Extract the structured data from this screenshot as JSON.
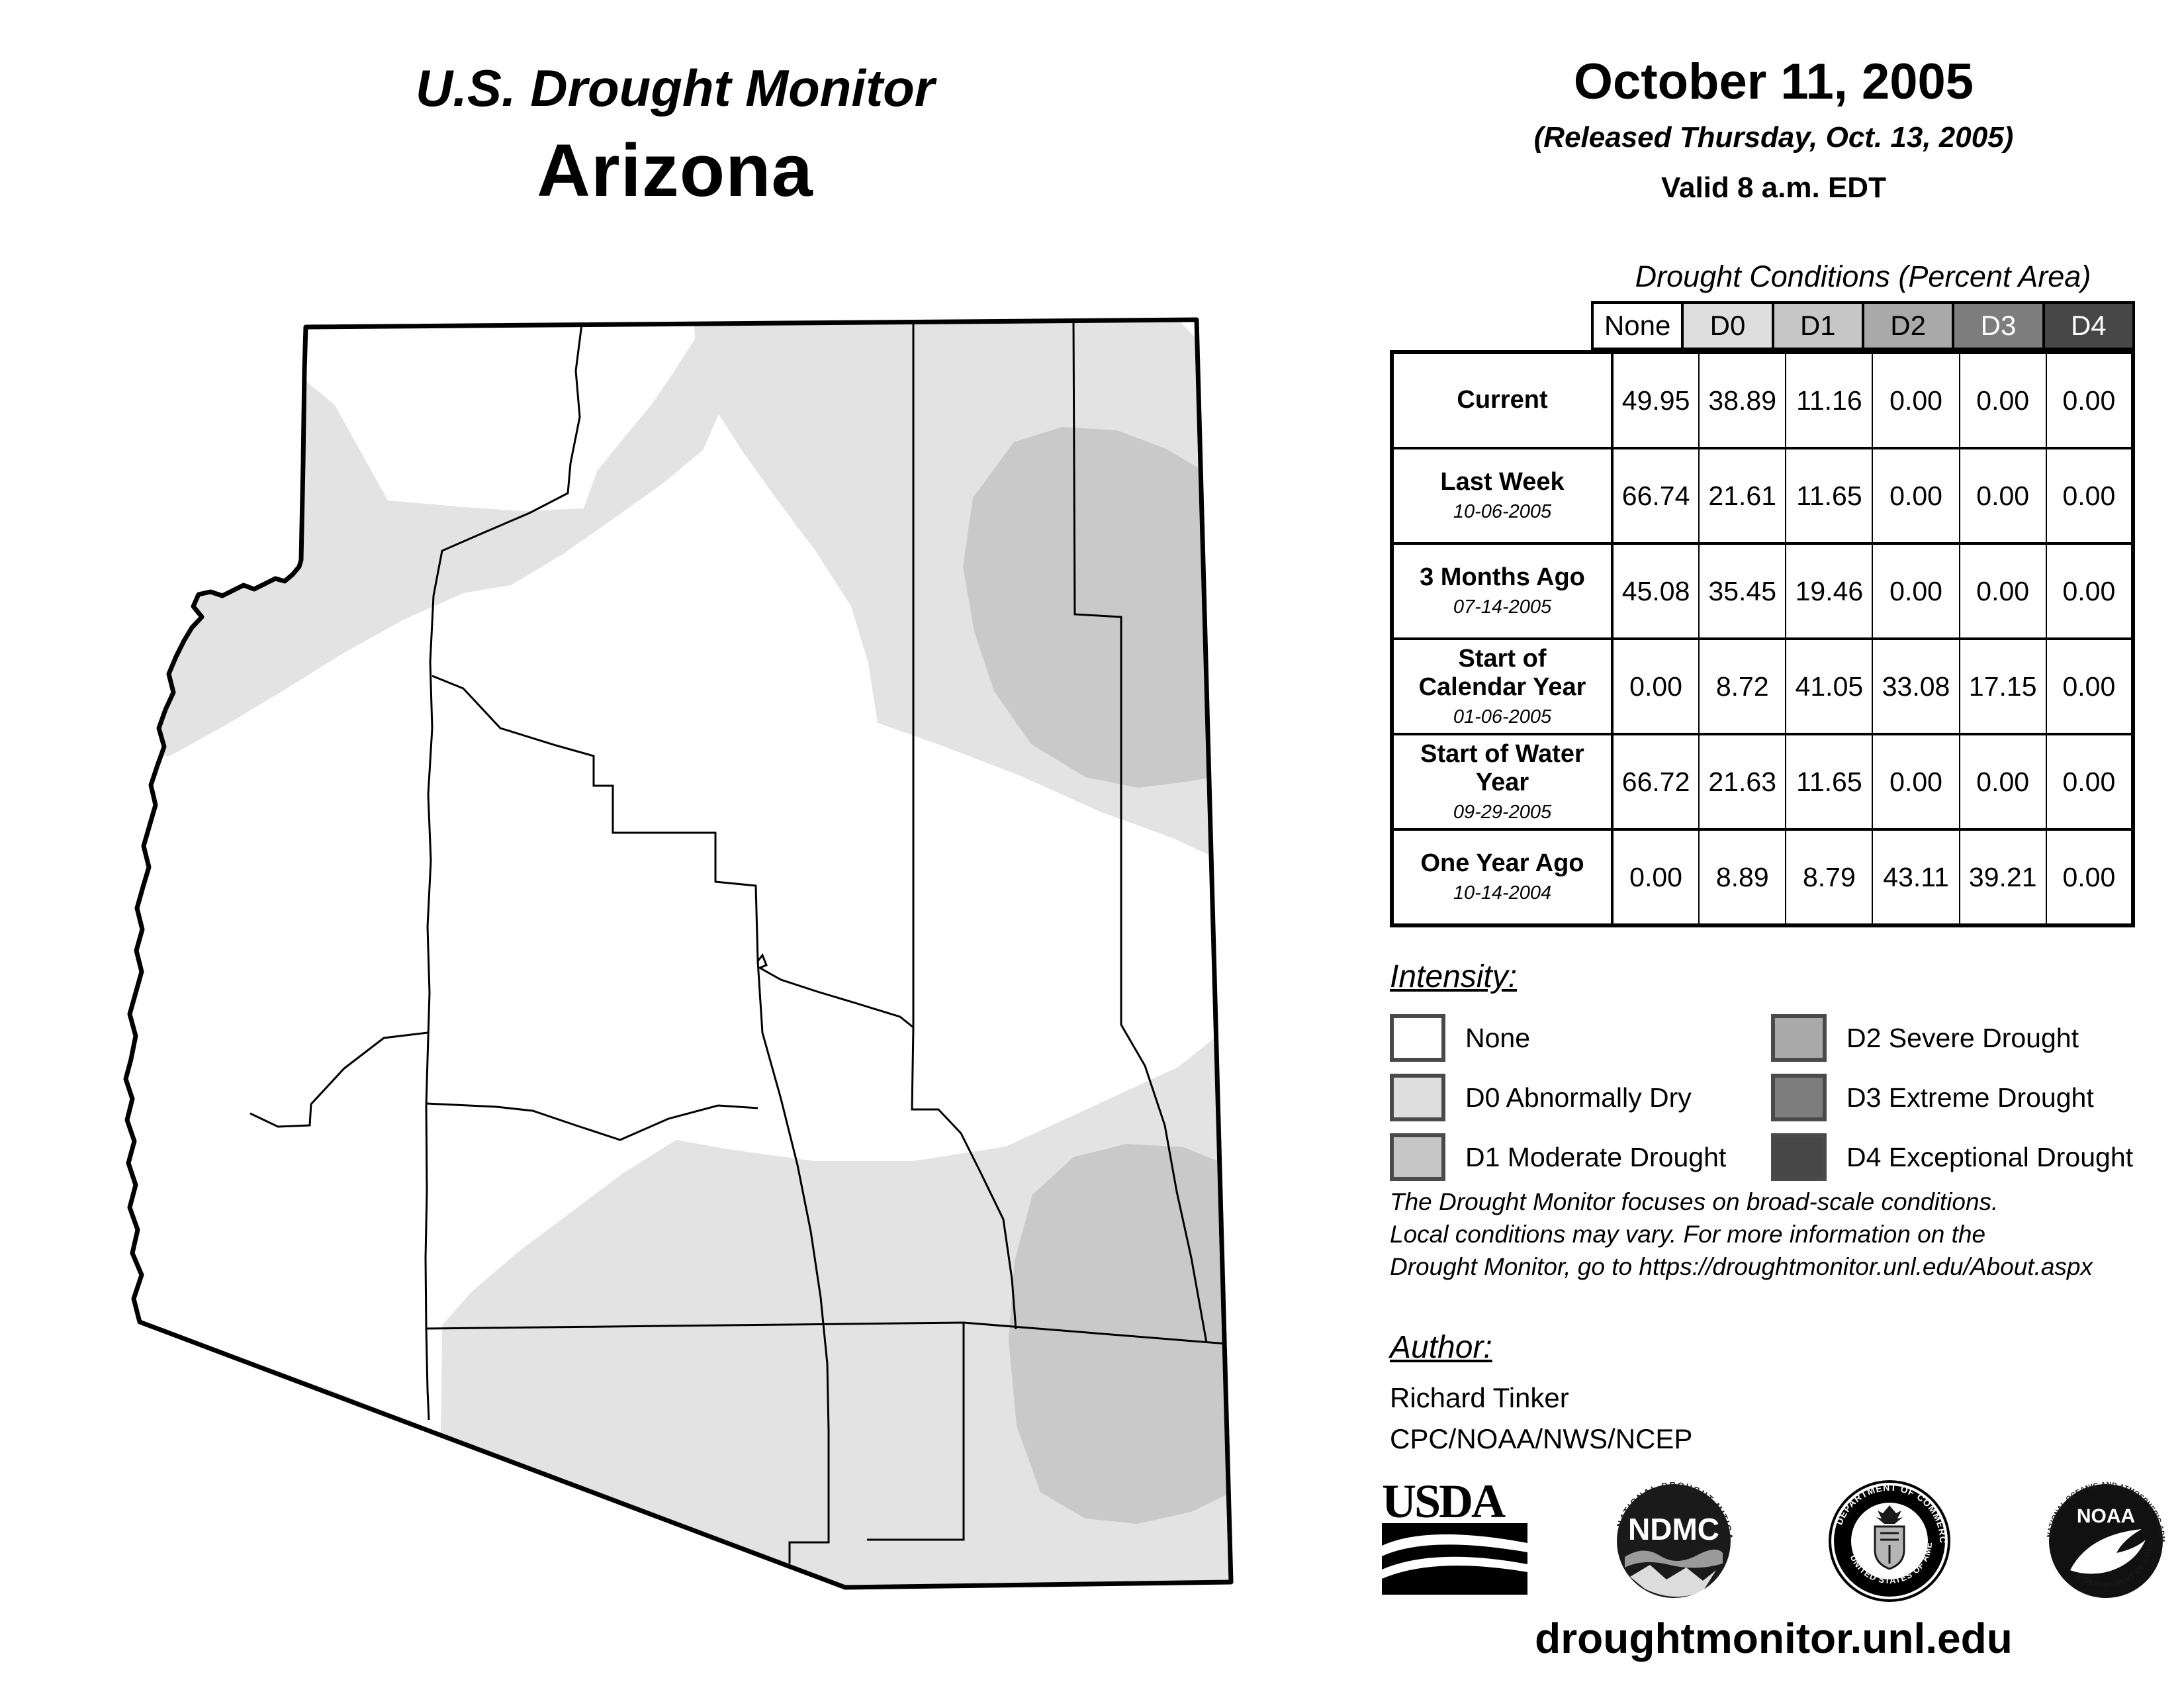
{
  "report": {
    "product_title": "U.S. Drought Monitor",
    "region": "Arizona",
    "date": "October 11, 2005",
    "released": "(Released Thursday, Oct. 13, 2005)",
    "valid": "Valid 8 a.m. EDT"
  },
  "table": {
    "caption": "Drought Conditions (Percent Area)",
    "columns": [
      "None",
      "D0",
      "D1",
      "D2",
      "D3",
      "D4"
    ],
    "rows": [
      {
        "label": "Current",
        "date": "",
        "values": [
          "49.95",
          "38.89",
          "11.16",
          "0.00",
          "0.00",
          "0.00"
        ]
      },
      {
        "label": "Last Week",
        "date": "10-06-2005",
        "values": [
          "66.74",
          "21.61",
          "11.65",
          "0.00",
          "0.00",
          "0.00"
        ]
      },
      {
        "label": "3 Months Ago",
        "date": "07-14-2005",
        "values": [
          "45.08",
          "35.45",
          "19.46",
          "0.00",
          "0.00",
          "0.00"
        ]
      },
      {
        "label": "Start of Calendar Year",
        "date": "01-06-2005",
        "values": [
          "0.00",
          "8.72",
          "41.05",
          "33.08",
          "17.15",
          "0.00"
        ]
      },
      {
        "label": "Start of Water Year",
        "date": "09-29-2005",
        "values": [
          "66.72",
          "21.63",
          "11.65",
          "0.00",
          "0.00",
          "0.00"
        ]
      },
      {
        "label": "One Year Ago",
        "date": "10-14-2004",
        "values": [
          "0.00",
          "8.89",
          "8.79",
          "43.11",
          "39.21",
          "0.00"
        ]
      }
    ]
  },
  "chart_data": {
    "type": "table",
    "title": "Drought Conditions (Percent Area)",
    "categories": [
      "None",
      "D0",
      "D1",
      "D2",
      "D3",
      "D4"
    ],
    "series": [
      {
        "name": "Current",
        "values": [
          49.95,
          38.89,
          11.16,
          0.0,
          0.0,
          0.0
        ]
      },
      {
        "name": "Last Week 10-06-2005",
        "values": [
          66.74,
          21.61,
          11.65,
          0.0,
          0.0,
          0.0
        ]
      },
      {
        "name": "3 Months Ago 07-14-2005",
        "values": [
          45.08,
          35.45,
          19.46,
          0.0,
          0.0,
          0.0
        ]
      },
      {
        "name": "Start of Calendar Year 01-06-2005",
        "values": [
          0.0,
          8.72,
          41.05,
          33.08,
          17.15,
          0.0
        ]
      },
      {
        "name": "Start of Water Year 09-29-2005",
        "values": [
          66.72,
          21.63,
          11.65,
          0.0,
          0.0,
          0.0
        ]
      },
      {
        "name": "One Year Ago 10-14-2004",
        "values": [
          0.0,
          8.89,
          8.79,
          43.11,
          39.21,
          0.0
        ]
      }
    ]
  },
  "legend": {
    "heading": "Intensity:",
    "items": [
      {
        "label": "None",
        "color": "#ffffff"
      },
      {
        "label": "D0 Abnormally Dry",
        "color": "#dedede"
      },
      {
        "label": "D1 Moderate Drought",
        "color": "#c6c6c6"
      },
      {
        "label": "D2 Severe Drought",
        "color": "#a9a9a9"
      },
      {
        "label": "D3 Extreme Drought",
        "color": "#7d7d7d"
      },
      {
        "label": "D4 Exceptional Drought",
        "color": "#474747"
      }
    ]
  },
  "notes": {
    "line1": "The Drought Monitor focuses on broad-scale conditions.",
    "line2": "Local conditions may vary. For more information on the",
    "line3": "Drought Monitor, go to https://droughtmonitor.unl.edu/About.aspx"
  },
  "author": {
    "heading": "Author:",
    "name": "Richard Tinker",
    "org": "CPC/NOAA/NWS/NCEP"
  },
  "logos": {
    "usda": "USDA",
    "ndmc": "NDMC",
    "ndmc_ring_top": "NATIONAL DROUGHT MITIGATION CENTER",
    "ndmc_ring_bottom": "UNIVERSITY OF NEBRASKA",
    "doc_ring_top": "DEPARTMENT OF COMMERCE",
    "doc_ring_bottom": "UNITED STATES OF AMERICA",
    "noaa": "NOAA",
    "noaa_ring_top": "NATIONAL OCEANIC AND ATMOSPHERIC ADMINISTRATION",
    "noaa_ring_bottom": "U.S. DEPARTMENT OF COMMERCE"
  },
  "footer": {
    "url": "droughtmonitor.unl.edu"
  },
  "colors": {
    "map_d0": "#e3e3e3",
    "map_d1": "#c9c9c9",
    "outline": "#000000"
  }
}
